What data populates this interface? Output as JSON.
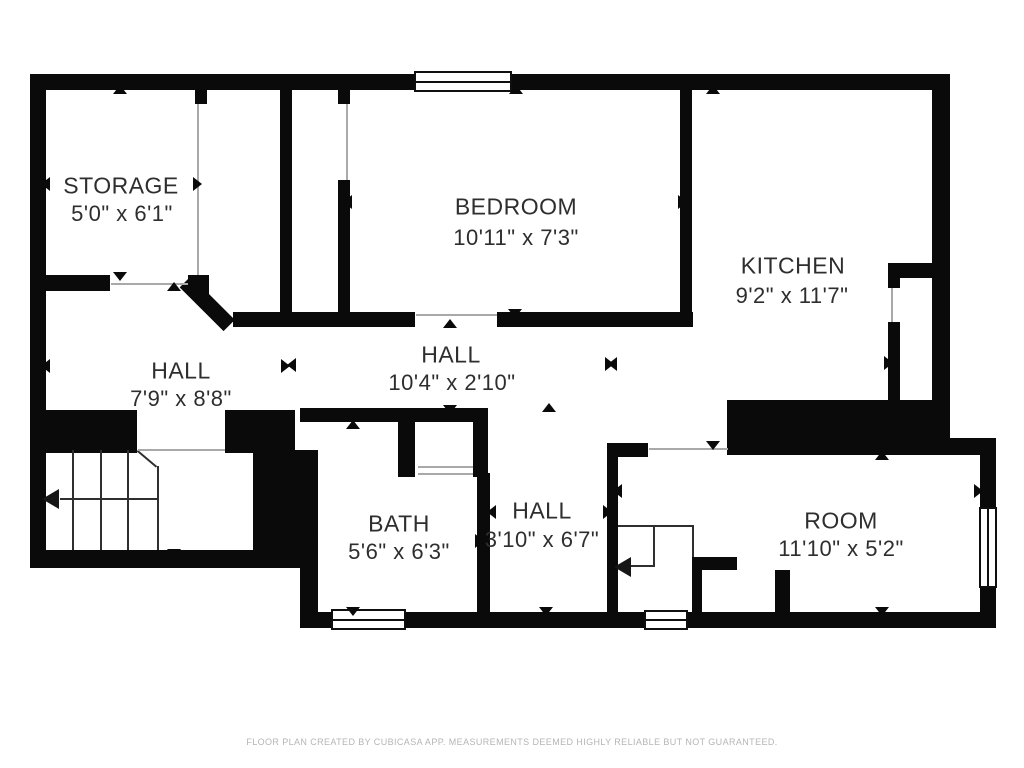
{
  "footer": {
    "text": "FLOOR PLAN CREATED BY CUBICASA APP. MEASUREMENTS DEEMED HIGHLY RELIABLE BUT NOT GUARANTEED."
  },
  "colors": {
    "wall": "#0a0a0a",
    "label_text": "#2e2e2e",
    "footer_text": "#b5b5b5",
    "door_line": "#a9a9a9",
    "background": "#ffffff"
  },
  "rooms": [
    {
      "id": "storage",
      "name": "STORAGE",
      "dims": "5'0\" x 6'1\"",
      "name_pos": {
        "x": 121,
        "y": 186
      },
      "dims_pos": {
        "x": 122,
        "y": 214
      }
    },
    {
      "id": "bedroom",
      "name": "BEDROOM",
      "dims": "10'11\" x 7'3\"",
      "name_pos": {
        "x": 516,
        "y": 207
      },
      "dims_pos": {
        "x": 516,
        "y": 238
      }
    },
    {
      "id": "kitchen",
      "name": "KITCHEN",
      "dims": "9'2\" x 11'7\"",
      "name_pos": {
        "x": 793,
        "y": 266
      },
      "dims_pos": {
        "x": 792,
        "y": 296
      }
    },
    {
      "id": "hall-left",
      "name": "HALL",
      "dims": "7'9\" x 8'8\"",
      "name_pos": {
        "x": 181,
        "y": 371
      },
      "dims_pos": {
        "x": 181,
        "y": 399
      }
    },
    {
      "id": "hall-center",
      "name": "HALL",
      "dims": "10'4\" x 2'10\"",
      "name_pos": {
        "x": 451,
        "y": 355
      },
      "dims_pos": {
        "x": 452,
        "y": 383
      }
    },
    {
      "id": "bath",
      "name": "BATH",
      "dims": "5'6\" x 6'3\"",
      "name_pos": {
        "x": 399,
        "y": 524
      },
      "dims_pos": {
        "x": 399,
        "y": 552
      }
    },
    {
      "id": "hall-small",
      "name": "HALL",
      "dims": "3'10\" x 6'7\"",
      "name_pos": {
        "x": 542,
        "y": 511
      },
      "dims_pos": {
        "x": 542,
        "y": 540
      }
    },
    {
      "id": "room",
      "name": "ROOM",
      "dims": "11'10\" x 5'2\"",
      "name_pos": {
        "x": 841,
        "y": 521
      },
      "dims_pos": {
        "x": 841,
        "y": 549
      }
    }
  ],
  "walls": [
    {
      "x": 30,
      "y": 74,
      "w": 920,
      "h": 16
    },
    {
      "x": 30,
      "y": 74,
      "w": 16,
      "h": 494
    },
    {
      "x": 30,
      "y": 275,
      "w": 80,
      "h": 16
    },
    {
      "x": 188,
      "y": 275,
      "w": 21,
      "h": 19
    },
    {
      "x": 195,
      "y": 90,
      "w": 12,
      "h": 14
    },
    {
      "x": 280,
      "y": 90,
      "w": 12,
      "h": 237
    },
    {
      "x": 233,
      "y": 312,
      "w": 182,
      "h": 15
    },
    {
      "x": 338,
      "y": 90,
      "w": 12,
      "h": 14
    },
    {
      "x": 338,
      "y": 180,
      "w": 12,
      "h": 143
    },
    {
      "x": 497,
      "y": 312,
      "w": 196,
      "h": 15
    },
    {
      "x": 680,
      "y": 90,
      "w": 12,
      "h": 233
    },
    {
      "x": 932,
      "y": 74,
      "w": 18,
      "h": 330
    },
    {
      "x": 888,
      "y": 263,
      "w": 44,
      "h": 15
    },
    {
      "x": 888,
      "y": 278,
      "w": 12,
      "h": 10
    },
    {
      "x": 888,
      "y": 322,
      "w": 12,
      "h": 80
    },
    {
      "x": 727,
      "y": 400,
      "w": 223,
      "h": 55
    },
    {
      "x": 948,
      "y": 438,
      "w": 48,
      "h": 17
    },
    {
      "x": 980,
      "y": 438,
      "w": 16,
      "h": 174
    },
    {
      "x": 607,
      "y": 443,
      "w": 41,
      "h": 14
    },
    {
      "x": 607,
      "y": 443,
      "w": 11,
      "h": 185
    },
    {
      "x": 607,
      "y": 612,
      "w": 389,
      "h": 16
    },
    {
      "x": 300,
      "y": 612,
      "w": 320,
      "h": 16
    },
    {
      "x": 300,
      "y": 568,
      "w": 18,
      "h": 44
    },
    {
      "x": 30,
      "y": 410,
      "w": 107,
      "h": 43
    },
    {
      "x": 225,
      "y": 410,
      "w": 70,
      "h": 43
    },
    {
      "x": 253,
      "y": 450,
      "w": 65,
      "h": 118
    },
    {
      "x": 30,
      "y": 550,
      "w": 275,
      "h": 18
    },
    {
      "x": 300,
      "y": 408,
      "w": 188,
      "h": 14
    },
    {
      "x": 398,
      "y": 408,
      "w": 17,
      "h": 69
    },
    {
      "x": 473,
      "y": 408,
      "w": 15,
      "h": 69
    },
    {
      "x": 477,
      "y": 473,
      "w": 13,
      "h": 139
    },
    {
      "x": 692,
      "y": 557,
      "w": 45,
      "h": 13
    },
    {
      "x": 692,
      "y": 570,
      "w": 10,
      "h": 42
    },
    {
      "x": 775,
      "y": 570,
      "w": 15,
      "h": 42
    }
  ],
  "diagonal_walls": [
    {
      "x": 191,
      "y": 276,
      "len": 62,
      "thickness": 16,
      "angle": 45
    }
  ],
  "windows": [
    {
      "x": 414,
      "y": 71,
      "w": 98,
      "h": 21,
      "orient": "h"
    },
    {
      "x": 331,
      "y": 609,
      "w": 75,
      "h": 21,
      "orient": "h"
    },
    {
      "x": 644,
      "y": 610,
      "w": 44,
      "h": 20,
      "orient": "h"
    },
    {
      "x": 979,
      "y": 507,
      "w": 18,
      "h": 81,
      "orient": "v"
    }
  ],
  "door_lines": [
    {
      "x": 197,
      "y": 104,
      "len": 171,
      "orient": "v"
    },
    {
      "x": 346,
      "y": 104,
      "len": 76,
      "orient": "v"
    },
    {
      "x": 416,
      "y": 314,
      "len": 81,
      "orient": "h"
    },
    {
      "x": 649,
      "y": 448,
      "len": 79,
      "orient": "h"
    },
    {
      "x": 418,
      "y": 466,
      "len": 55,
      "orient": "h"
    },
    {
      "x": 418,
      "y": 473,
      "len": 55,
      "orient": "h"
    },
    {
      "x": 891,
      "y": 288,
      "len": 34,
      "orient": "v"
    },
    {
      "x": 138,
      "y": 449,
      "len": 87,
      "orient": "h"
    },
    {
      "x": 111,
      "y": 283,
      "len": 77,
      "orient": "h"
    }
  ],
  "stair_lines": [
    {
      "x": 72,
      "y": 450,
      "len": 100,
      "orient": "v"
    },
    {
      "x": 100,
      "y": 450,
      "len": 100,
      "orient": "v"
    },
    {
      "x": 127,
      "y": 450,
      "len": 100,
      "orient": "v"
    },
    {
      "x": 157,
      "y": 466,
      "len": 84,
      "orient": "v"
    },
    {
      "x": 138,
      "y": 450,
      "len": 25,
      "orient": "d45"
    },
    {
      "x": 618,
      "y": 525,
      "len": 74,
      "orient": "h"
    },
    {
      "x": 692,
      "y": 525,
      "len": 32,
      "orient": "v"
    },
    {
      "x": 653,
      "y": 525,
      "len": 42,
      "orient": "v"
    }
  ],
  "stair_arrows": [
    {
      "shaft": {
        "x": 60,
        "y": 498,
        "len": 97
      },
      "head": {
        "x": 42,
        "y": 489
      }
    },
    {
      "shaft": {
        "x": 630,
        "y": 565,
        "len": 23
      },
      "head": {
        "x": 614,
        "y": 557
      }
    }
  ],
  "measure_arrows": [
    {
      "dir": "up",
      "x": 120,
      "y": 94
    },
    {
      "dir": "up",
      "x": 516,
      "y": 94
    },
    {
      "dir": "up",
      "x": 713,
      "y": 94
    },
    {
      "dir": "up",
      "x": 174,
      "y": 291
    },
    {
      "dir": "up",
      "x": 450,
      "y": 328
    },
    {
      "dir": "up",
      "x": 353,
      "y": 429
    },
    {
      "dir": "up",
      "x": 549,
      "y": 412
    },
    {
      "dir": "up",
      "x": 882,
      "y": 460
    },
    {
      "dir": "down",
      "x": 120,
      "y": 272
    },
    {
      "dir": "down",
      "x": 515,
      "y": 309
    },
    {
      "dir": "down",
      "x": 450,
      "y": 405
    },
    {
      "dir": "down",
      "x": 713,
      "y": 441
    },
    {
      "dir": "down",
      "x": 174,
      "y": 549
    },
    {
      "dir": "down",
      "x": 353,
      "y": 607
    },
    {
      "dir": "down",
      "x": 546,
      "y": 607
    },
    {
      "dir": "down",
      "x": 882,
      "y": 607
    },
    {
      "dir": "left",
      "x": 50,
      "y": 184
    },
    {
      "dir": "left",
      "x": 352,
      "y": 202
    },
    {
      "dir": "left",
      "x": 50,
      "y": 366
    },
    {
      "dir": "left",
      "x": 296,
      "y": 365
    },
    {
      "dir": "left",
      "x": 617,
      "y": 364
    },
    {
      "dir": "left",
      "x": 314,
      "y": 541
    },
    {
      "dir": "left",
      "x": 496,
      "y": 512
    },
    {
      "dir": "left",
      "x": 622,
      "y": 491
    },
    {
      "dir": "right",
      "x": 193,
      "y": 184
    },
    {
      "dir": "right",
      "x": 678,
      "y": 202
    },
    {
      "dir": "right",
      "x": 281,
      "y": 366
    },
    {
      "dir": "right",
      "x": 605,
      "y": 364
    },
    {
      "dir": "right",
      "x": 884,
      "y": 363
    },
    {
      "dir": "right",
      "x": 475,
      "y": 541
    },
    {
      "dir": "right",
      "x": 603,
      "y": 512
    },
    {
      "dir": "right",
      "x": 974,
      "y": 491
    }
  ]
}
